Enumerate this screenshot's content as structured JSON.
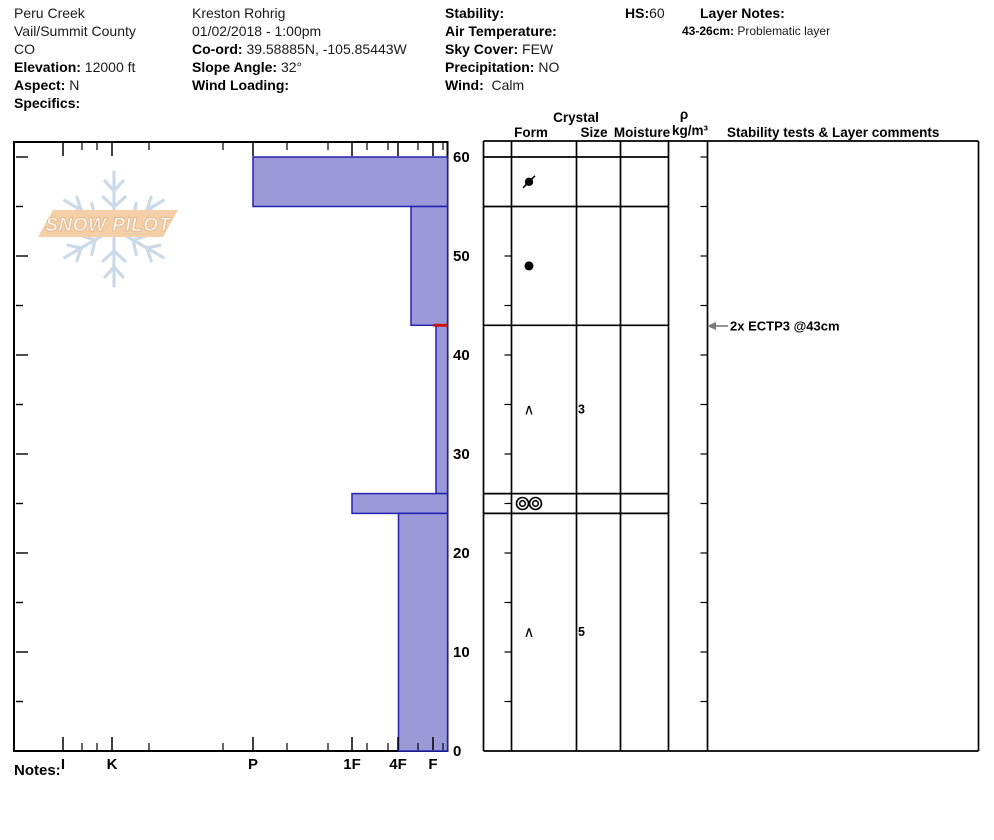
{
  "header": {
    "location": {
      "name": "Peru Creek",
      "region": "Vail/Summit County",
      "state": "CO",
      "elevation_label": "Elevation:",
      "elevation_value": "12000 ft",
      "aspect_label": "Aspect:",
      "aspect_value": "N",
      "specifics_label": "Specifics:"
    },
    "observer": {
      "name": "Kreston Rohrig",
      "datetime": "01/02/2018 - 1:00pm",
      "coord_label": "Co-ord:",
      "coord_value": "39.58885N, -105.85443W",
      "slope_label": "Slope Angle:",
      "slope_value": "32°",
      "wind_loading_label": "Wind Loading:"
    },
    "conditions": {
      "stability_label": "Stability:",
      "air_temp_label": "Air Temperature:",
      "sky_label": "Sky Cover:",
      "sky_value": "FEW",
      "precip_label": "Precipitation:",
      "precip_value": "NO",
      "wind_label": "Wind:",
      "wind_value": "Calm"
    },
    "hs_label": "HS:",
    "hs_value": "60",
    "layer_notes_label": "Layer Notes:",
    "layer_note_range": "43-26cm:",
    "layer_note_text": "Problematic layer"
  },
  "table_headers": {
    "crystal": "Crystal",
    "form": "Form",
    "size": "Size",
    "moisture": "Moisture",
    "rho": "ρ",
    "rho_units": "kg/m³",
    "comments": "Stability tests & Layer comments"
  },
  "axes": {
    "depth_labels": [
      "60",
      "50",
      "40",
      "30",
      "20",
      "10",
      "0"
    ],
    "hardness_labels": [
      "I",
      "K",
      "P",
      "1F",
      "4F",
      "F"
    ]
  },
  "notes_label": "Notes:",
  "logo": {
    "text": "SNOW PILOT"
  },
  "chart_data": {
    "type": "bar",
    "title": "Snow pit hardness profile",
    "xlabel": "Hand hardness (I K P 1F 4F F)",
    "ylabel": "Depth (cm)",
    "depth_range_cm": [
      0,
      60
    ],
    "hs_cm": 60,
    "hardness_categories": [
      "I",
      "K",
      "P",
      "1F",
      "4F",
      "F"
    ],
    "layers": [
      {
        "top_cm": 60,
        "bottom_cm": 55,
        "hardness": "P",
        "grain_form": "decomposing/rounded (dot with slash)",
        "grain_size_mm": "",
        "moisture": "",
        "density_kgm3": ""
      },
      {
        "top_cm": 55,
        "bottom_cm": 43,
        "hardness": "4F-",
        "grain_form": "rounded grains (filled dot)",
        "grain_size_mm": "",
        "moisture": "",
        "density_kgm3": ""
      },
      {
        "top_cm": 43,
        "bottom_cm": 26,
        "hardness": "F+",
        "grain_form": "facets (caret)",
        "grain_size_mm": "3",
        "moisture": "",
        "density_kgm3": ""
      },
      {
        "top_cm": 26,
        "bottom_cm": 24,
        "hardness": "1F",
        "grain_form": "melt-freeze clusters (double circles)",
        "grain_size_mm": "",
        "moisture": "",
        "density_kgm3": ""
      },
      {
        "top_cm": 24,
        "bottom_cm": 0,
        "hardness": "4F",
        "grain_form": "facets (caret)",
        "grain_size_mm": "5",
        "moisture": "",
        "density_kgm3": ""
      }
    ],
    "stability_tests": [
      {
        "label": "2x ECTP3 @43cm",
        "result": "2x ECTP3",
        "depth_cm": 43
      }
    ],
    "failure_plane": {
      "depth_cm": 43
    },
    "layer_notes": [
      {
        "range": "43-26cm",
        "note": "Problematic layer"
      }
    ],
    "symbols": {
      "facets": "∧"
    },
    "colors": {
      "layer_fill": "#9b99d8",
      "layer_stroke": "#2222b0",
      "failure_line": "#cc1111",
      "arrow_gray": "#7a7a7a",
      "logo_banner": "#f4cfa8",
      "logo_snowflake": "#cbdae8"
    },
    "layout_px": {
      "y0": 751,
      "px_per_cm": 9.9,
      "chart_left": 14,
      "chart_right": 447.5,
      "chart_top": 142,
      "hardness_scale_px": {
        "I": 63,
        "K": 112,
        "P": 253,
        "1F": 352,
        "4F": 398,
        "F": 433
      },
      "minor_tick_px": [
        82,
        97,
        149,
        223,
        287,
        328,
        367,
        388,
        418,
        443
      ],
      "layer_left_px": [
        253,
        411,
        436,
        352,
        398.5
      ],
      "row_line_depths": [
        60,
        55,
        43,
        26,
        24
      ]
    }
  }
}
